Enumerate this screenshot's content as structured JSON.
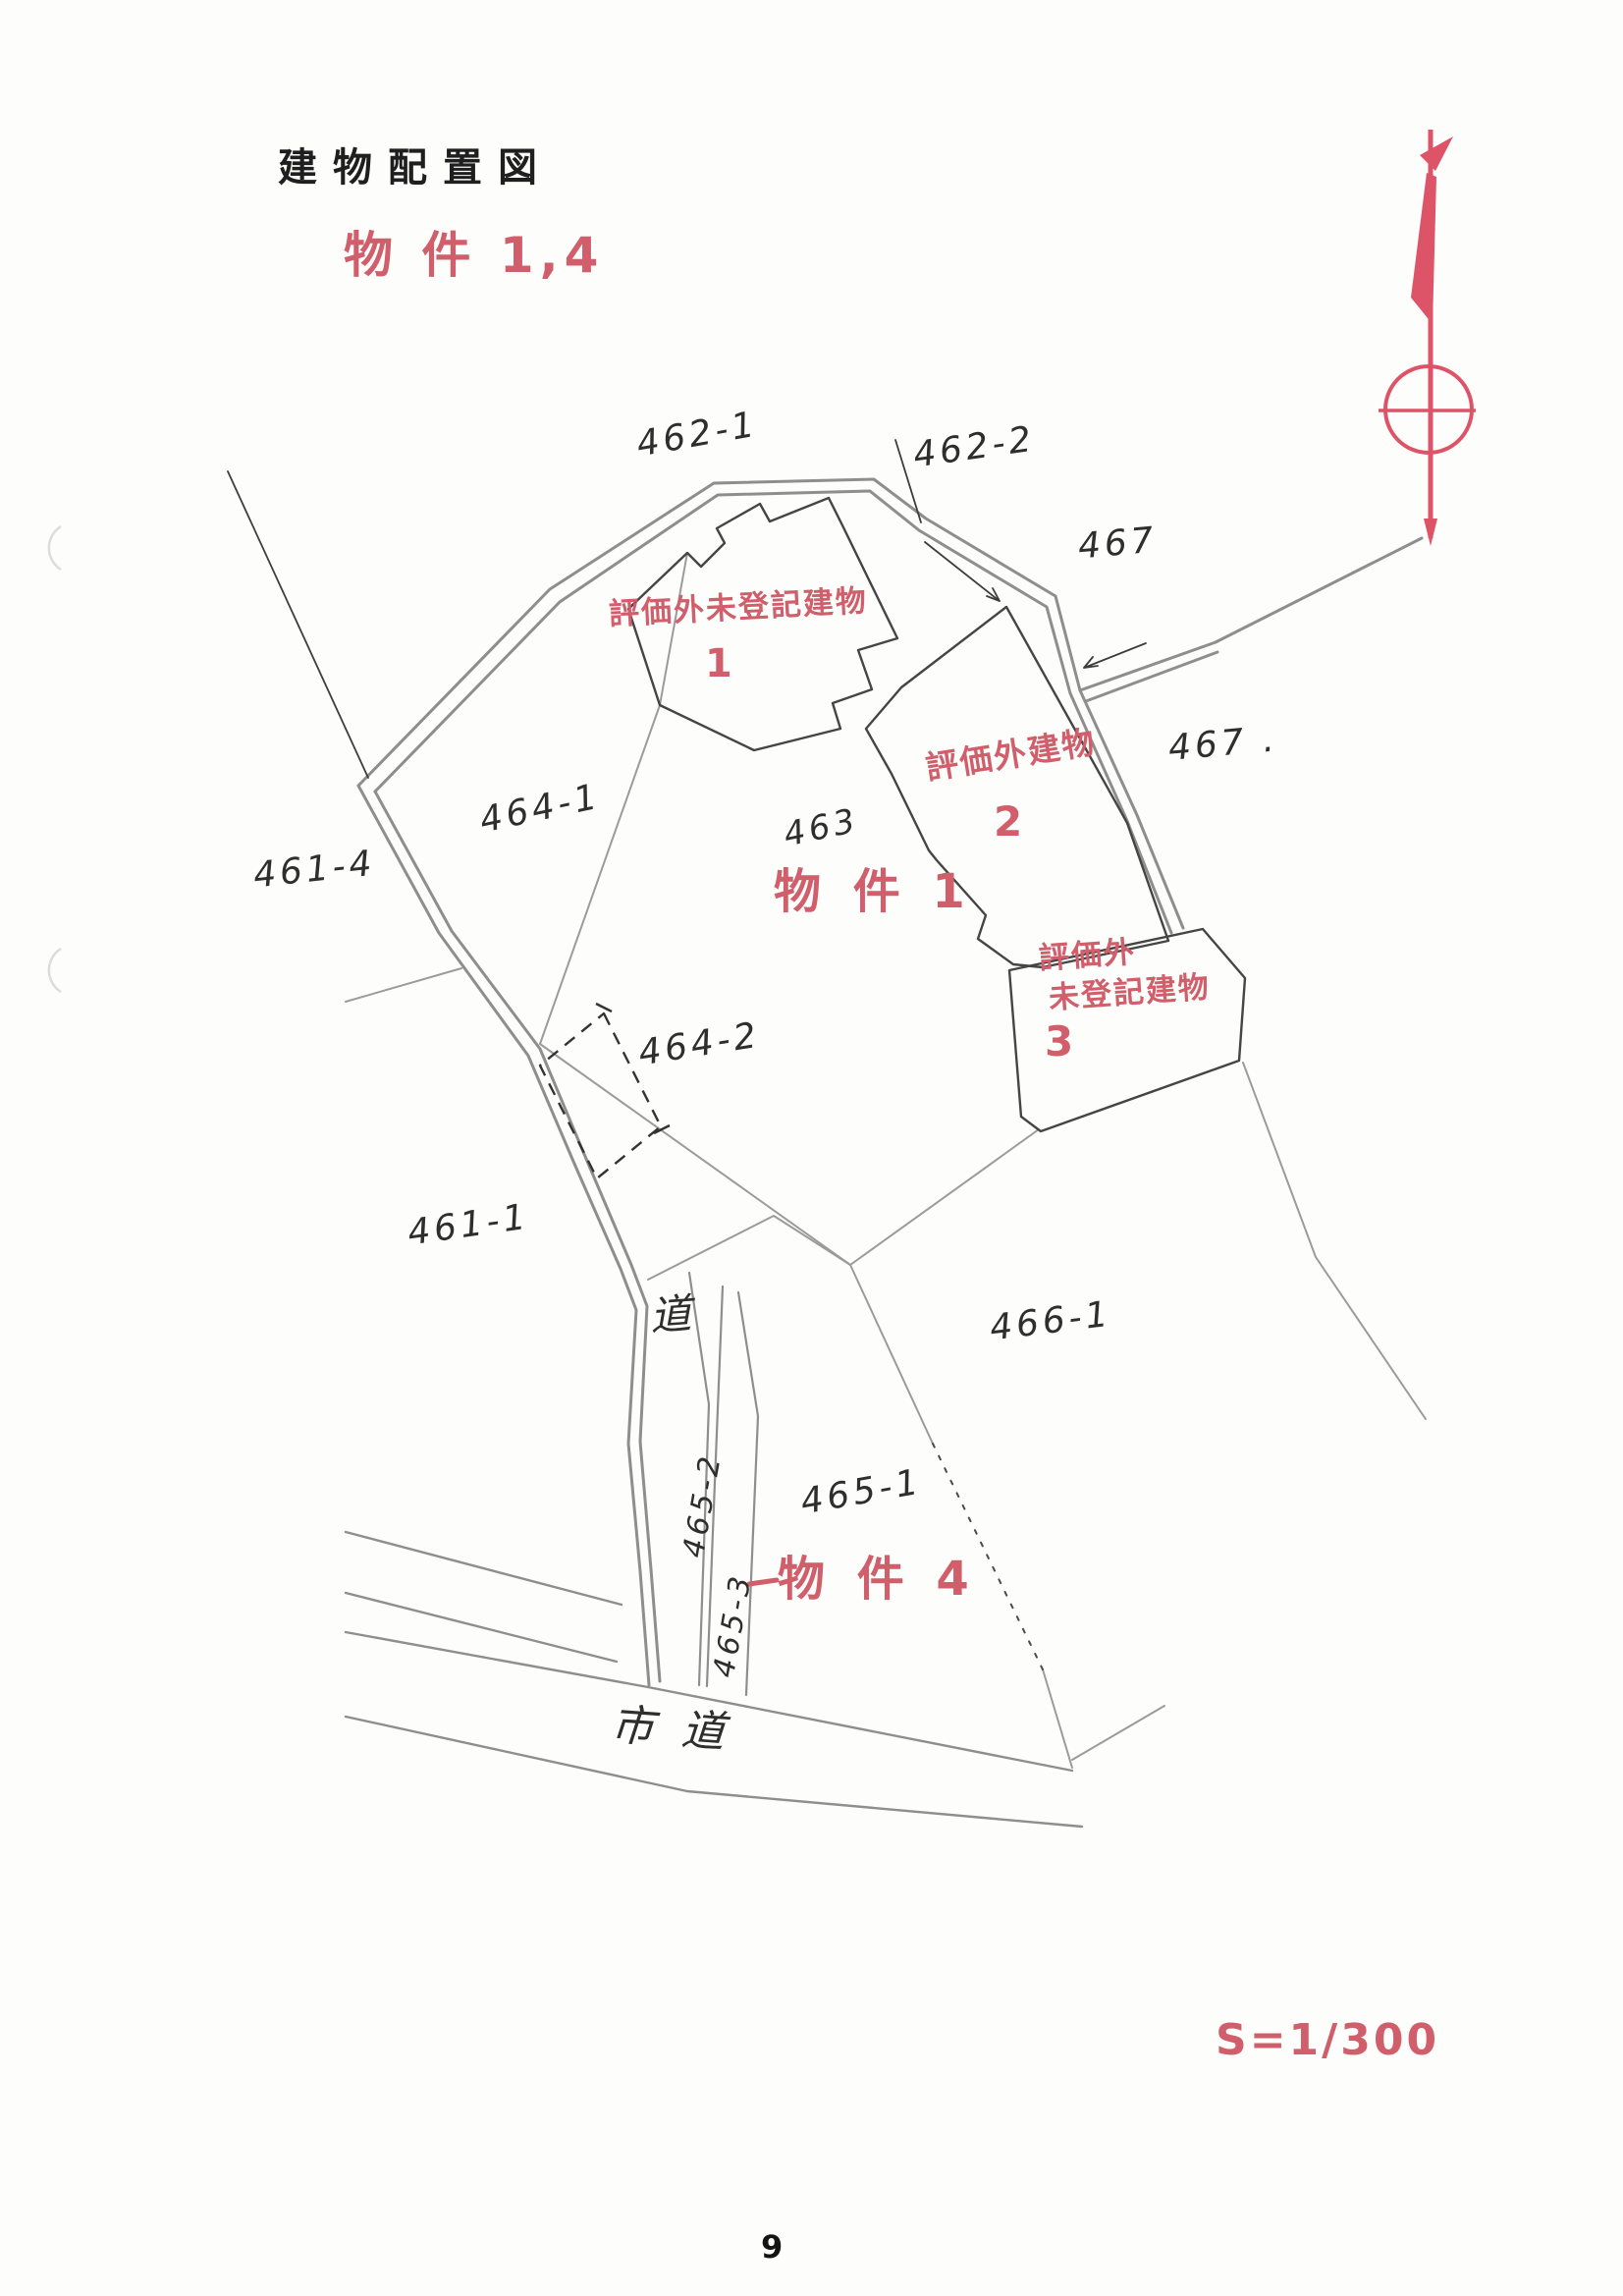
{
  "document": {
    "title": "建物配置図",
    "subject_label": "物 件 1,4",
    "scale_label": "S=1/300",
    "page_number": "9"
  },
  "map": {
    "parcel_labels": [
      {
        "id": "462-1",
        "text": "462-1"
      },
      {
        "id": "462-2",
        "text": "462-2"
      },
      {
        "id": "467-upper",
        "text": "467"
      },
      {
        "id": "467-lower",
        "text": "467 ."
      },
      {
        "id": "464-1",
        "text": "464-1"
      },
      {
        "id": "461-4",
        "text": "461-4"
      },
      {
        "id": "463",
        "text": "463"
      },
      {
        "id": "464-2",
        "text": "464-2"
      },
      {
        "id": "461-1",
        "text": "461-1"
      },
      {
        "id": "466-1",
        "text": "466-1"
      },
      {
        "id": "465-1",
        "text": "465-1"
      },
      {
        "id": "465-2",
        "text": "465-2"
      },
      {
        "id": "465-3",
        "text": "465-3"
      }
    ],
    "road_labels": [
      {
        "text": "道"
      },
      {
        "text": "市道"
      }
    ],
    "annotations": {
      "building1_title": "評価外未登記建物",
      "building1_number": "1",
      "building2_title": "評価外建物",
      "building2_number": "2",
      "building3_title_line1": "評価外",
      "building3_title_line2": "未登記建物",
      "building3_number": "3",
      "subject1": "物 件 1",
      "subject4": "物 件 4"
    },
    "colors": {
      "annotation_red": "#d15f6b",
      "ink": "#2e2e2e",
      "pencil": "#8e8e8e"
    }
  }
}
